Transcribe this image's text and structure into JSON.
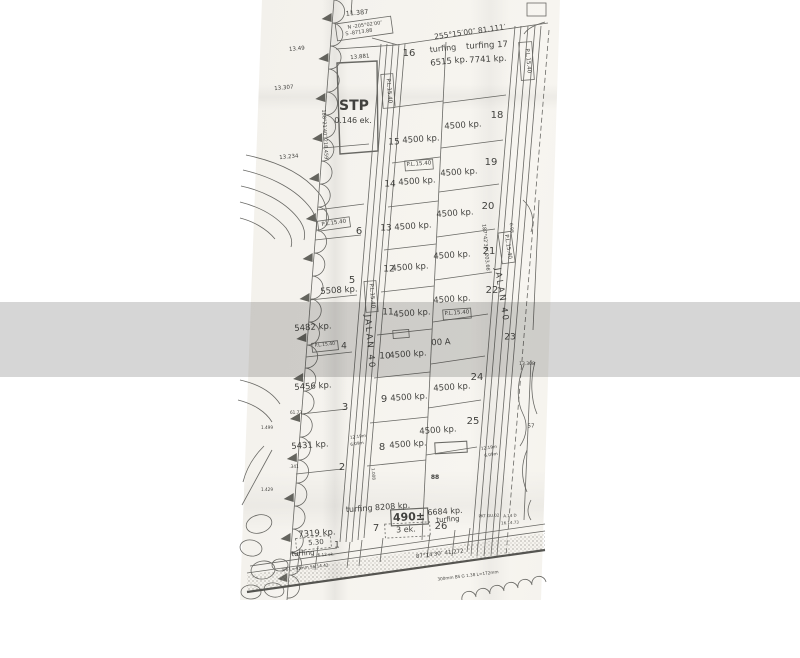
{
  "watermark": {
    "text": "Nazree Abdul Aziz"
  },
  "brand": {
    "name": "PropertyGuru",
    "icon": "propertyguru-house-icon"
  },
  "colors": {
    "ink": "#4a4a46",
    "paper": "#f5f3ee",
    "band": "rgba(30,30,30,0.185)",
    "watermark_text": "rgba(255,255,255,0.62)"
  },
  "map": {
    "road_names": [
      "JALAN 40",
      "JALAN 40"
    ],
    "labels": [
      {
        "t": "11.387",
        "x": 357,
        "y": 13,
        "s": 6.5,
        "r": -5
      },
      {
        "t": "N -205°02′00″",
        "x": 365,
        "y": 26,
        "s": 5,
        "r": -8
      },
      {
        "t": "S -8713.88",
        "x": 359,
        "y": 33,
        "s": 5,
        "r": -8
      },
      {
        "t": "255°15′00″   81.111′",
        "x": 470,
        "y": 32,
        "s": 7.5,
        "r": -8
      },
      {
        "t": "13.49",
        "x": 297,
        "y": 50,
        "s": 5.5,
        "r": -5
      },
      {
        "t": "16",
        "x": 409,
        "y": 54,
        "s": 10
      },
      {
        "t": "turfing",
        "x": 443,
        "y": 49,
        "s": 8,
        "r": -6
      },
      {
        "t": "6515 kp.",
        "x": 449,
        "y": 62,
        "s": 8.5,
        "r": -6
      },
      {
        "t": "turfing 17",
        "x": 487,
        "y": 46,
        "s": 8.5,
        "r": -3
      },
      {
        "t": "7741 kp.",
        "x": 488,
        "y": 60,
        "s": 8.5,
        "r": -3
      },
      {
        "t": "13.881",
        "x": 360,
        "y": 58,
        "s": 5.5,
        "r": -5
      },
      {
        "t": "13.307",
        "x": 284,
        "y": 89,
        "s": 5.5,
        "r": -5
      },
      {
        "t": "13.234",
        "x": 289,
        "y": 158,
        "s": 5.5,
        "r": -5
      },
      {
        "t": "188°21′40″  218.459′",
        "x": 324,
        "y": 135,
        "s": 5,
        "r": 87
      },
      {
        "t": "STP",
        "x": 354,
        "y": 106,
        "s": 14,
        "b": 1
      },
      {
        "t": "0.146 ek.",
        "x": 353,
        "y": 121,
        "s": 8
      },
      {
        "t": "P.L.15.40",
        "x": 388,
        "y": 91,
        "s": 5.5,
        "r": 85
      },
      {
        "t": "P.L.15.40",
        "x": 527,
        "y": 61,
        "s": 5.5,
        "r": 85
      },
      {
        "t": "15",
        "x": 394,
        "y": 143,
        "s": 9
      },
      {
        "t": "4500 kp.",
        "x": 421,
        "y": 140,
        "s": 8.5,
        "r": -4
      },
      {
        "t": "18",
        "x": 497,
        "y": 116,
        "s": 10
      },
      {
        "t": "4500 kp.",
        "x": 463,
        "y": 126,
        "s": 8.5,
        "r": -4
      },
      {
        "t": "P.L.15.40",
        "x": 419,
        "y": 165,
        "s": 5.5,
        "r": -4
      },
      {
        "t": "19",
        "x": 491,
        "y": 163,
        "s": 10
      },
      {
        "t": "4500 kp.",
        "x": 459,
        "y": 173,
        "s": 8.5,
        "r": -4
      },
      {
        "t": "14",
        "x": 390,
        "y": 185,
        "s": 9
      },
      {
        "t": "4500 kp.",
        "x": 417,
        "y": 182,
        "s": 8.5,
        "r": -4
      },
      {
        "t": "20",
        "x": 488,
        "y": 207,
        "s": 10
      },
      {
        "t": "4500 kp.",
        "x": 455,
        "y": 214,
        "s": 8.5,
        "r": -4
      },
      {
        "t": "13",
        "x": 386,
        "y": 229,
        "s": 9
      },
      {
        "t": "4500 kp.",
        "x": 413,
        "y": 227,
        "s": 8.5,
        "r": -4
      },
      {
        "t": "P.L.15.40",
        "x": 334,
        "y": 224,
        "s": 5.5,
        "r": -8
      },
      {
        "t": "6",
        "x": 359,
        "y": 232,
        "s": 10
      },
      {
        "t": "187°42′30″  203.66′",
        "x": 485,
        "y": 248,
        "s": 5,
        "r": 85
      },
      {
        "t": "0.98",
        "x": 510,
        "y": 228,
        "s": 4.5,
        "r": 85
      },
      {
        "t": "21",
        "x": 489,
        "y": 252,
        "s": 10
      },
      {
        "t": "4500 kp.",
        "x": 452,
        "y": 256,
        "s": 8.5,
        "r": -4
      },
      {
        "t": "12",
        "x": 389,
        "y": 270,
        "s": 9
      },
      {
        "t": "4500 kp.",
        "x": 410,
        "y": 268,
        "s": 8.5,
        "r": -4
      },
      {
        "t": "5",
        "x": 352,
        "y": 281,
        "s": 10
      },
      {
        "t": "5508 kp.",
        "x": 339,
        "y": 291,
        "s": 8.5,
        "r": -4
      },
      {
        "t": "22",
        "x": 492,
        "y": 291,
        "s": 10
      },
      {
        "t": "4500 kp.",
        "x": 452,
        "y": 300,
        "s": 8.5,
        "r": -4
      },
      {
        "t": "P.L.15.40",
        "x": 371,
        "y": 296,
        "s": 5.5,
        "r": 85
      },
      {
        "t": "JALAN 40",
        "x": 369,
        "y": 342,
        "s": 8.5,
        "r": 85,
        "ls": 2
      },
      {
        "t": "P.L.15.40",
        "x": 507,
        "y": 247,
        "s": 5.5,
        "r": 81
      },
      {
        "t": "JALAN 40",
        "x": 501,
        "y": 295,
        "s": 8.5,
        "r": 81,
        "ls": 2
      },
      {
        "t": "11",
        "x": 388,
        "y": 313,
        "s": 9
      },
      {
        "t": "4500 kp.",
        "x": 412,
        "y": 314,
        "s": 8.5,
        "r": -4
      },
      {
        "t": "P.L.15.40",
        "x": 457,
        "y": 314,
        "s": 5.5,
        "r": -4
      },
      {
        "t": "5482 kp.",
        "x": 313,
        "y": 328,
        "s": 8.5,
        "r": -4
      },
      {
        "t": "P.L.15.40",
        "x": 325,
        "y": 346,
        "s": 4.5,
        "r": -6
      },
      {
        "t": "4",
        "x": 344,
        "y": 347,
        "s": 9
      },
      {
        "t": "00 A",
        "x": 441,
        "y": 343,
        "s": 8.5,
        "r": -3
      },
      {
        "t": "23",
        "x": 510,
        "y": 338,
        "s": 9
      },
      {
        "t": "10",
        "x": 385,
        "y": 357,
        "s": 9
      },
      {
        "t": "4500 kp.",
        "x": 408,
        "y": 355,
        "s": 8.5,
        "r": -4
      },
      {
        "t": "13.308",
        "x": 527,
        "y": 365,
        "s": 4.5
      },
      {
        "t": "5456 kp.",
        "x": 313,
        "y": 387,
        "s": 8.5,
        "r": -4
      },
      {
        "t": "3",
        "x": 345,
        "y": 408,
        "s": 10
      },
      {
        "t": "9",
        "x": 384,
        "y": 400,
        "s": 10
      },
      {
        "t": "4500 kp.",
        "x": 409,
        "y": 398,
        "s": 8.5,
        "r": -4
      },
      {
        "t": "24",
        "x": 477,
        "y": 378,
        "s": 10
      },
      {
        "t": "4500 kp.",
        "x": 452,
        "y": 388,
        "s": 8.5,
        "r": -4
      },
      {
        "t": "61.73",
        "x": 296,
        "y": 413,
        "s": 4.2
      },
      {
        "t": "1.499",
        "x": 267,
        "y": 428,
        "s": 4.2
      },
      {
        "t": "12.19m",
        "x": 358,
        "y": 437,
        "s": 4.2,
        "r": -8
      },
      {
        "t": "6.09m",
        "x": 357,
        "y": 444,
        "s": 4.2,
        "r": -8
      },
      {
        "t": "25",
        "x": 473,
        "y": 422,
        "s": 10
      },
      {
        "t": "4500 kp.",
        "x": 438,
        "y": 431,
        "s": 8.5,
        "r": -4
      },
      {
        "t": "57",
        "x": 531,
        "y": 427,
        "s": 5.5
      },
      {
        "t": "5431 kp.",
        "x": 310,
        "y": 446,
        "s": 8.5,
        "r": -4
      },
      {
        "t": "8",
        "x": 382,
        "y": 448,
        "s": 10
      },
      {
        "t": "4500 kp.",
        "x": 408,
        "y": 445,
        "s": 8.5,
        "r": -4
      },
      {
        "t": "12.19m",
        "x": 489,
        "y": 448,
        "s": 4.2,
        "r": -8
      },
      {
        "t": "6.09m",
        "x": 491,
        "y": 455,
        "s": 4.2,
        "r": -8
      },
      {
        "t": ".341",
        "x": 294,
        "y": 467,
        "s": 4.2
      },
      {
        "t": "2",
        "x": 342,
        "y": 468,
        "s": 10
      },
      {
        "t": "1.008",
        "x": 373,
        "y": 474,
        "s": 4.2,
        "r": 85
      },
      {
        "t": "1.429",
        "x": 267,
        "y": 490,
        "s": 4.2
      },
      {
        "t": "88",
        "x": 435,
        "y": 478,
        "s": 6,
        "b": 1
      },
      {
        "t": "turfing 8208 kp.",
        "x": 378,
        "y": 508,
        "s": 8,
        "r": -4
      },
      {
        "t": "490±",
        "x": 409,
        "y": 517,
        "s": 11,
        "b": 1,
        "r": -3
      },
      {
        "t": "6684 kp.",
        "x": 445,
        "y": 512,
        "s": 8,
        "r": -4
      },
      {
        "t": "turfing",
        "x": 448,
        "y": 520,
        "s": 7,
        "r": -4
      },
      {
        "t": "26",
        "x": 441,
        "y": 527,
        "s": 10
      },
      {
        "t": "7",
        "x": 376,
        "y": 529,
        "s": 10
      },
      {
        "t": "3 ek.",
        "x": 406,
        "y": 530,
        "s": 8,
        "r": -3
      },
      {
        "t": "PKT GU.02",
        "x": 489,
        "y": 516,
        "s": 4,
        "r": -3
      },
      {
        "t": "A.14 D",
        "x": 510,
        "y": 516,
        "s": 4,
        "r": -3
      },
      {
        "t": "16.14.73",
        "x": 510,
        "y": 523,
        "s": 4,
        "r": -3
      },
      {
        "t": "7319 kp.",
        "x": 317,
        "y": 534,
        "s": 8.5,
        "r": -4
      },
      {
        "t": "5.30",
        "x": 316,
        "y": 543,
        "s": 7,
        "r": -5
      },
      {
        "t": "1",
        "x": 337,
        "y": 546,
        "s": 9
      },
      {
        "t": "turfing",
        "x": 303,
        "y": 554,
        "s": 7,
        "r": -4
      },
      {
        "t": "6.12 ek.",
        "x": 326,
        "y": 555,
        "s": 4.2,
        "r": -4
      },
      {
        "t": "87°14′30″  41.272",
        "x": 440,
        "y": 555,
        "s": 5.5,
        "r": -7
      },
      {
        "t": "3/8 L=43mm  56.14.42",
        "x": 305,
        "y": 568,
        "s": 4.2,
        "r": -6
      },
      {
        "t": "300mm BS  G 1.38  L=172mm",
        "x": 468,
        "y": 576,
        "s": 4.2,
        "r": -7
      }
    ]
  }
}
